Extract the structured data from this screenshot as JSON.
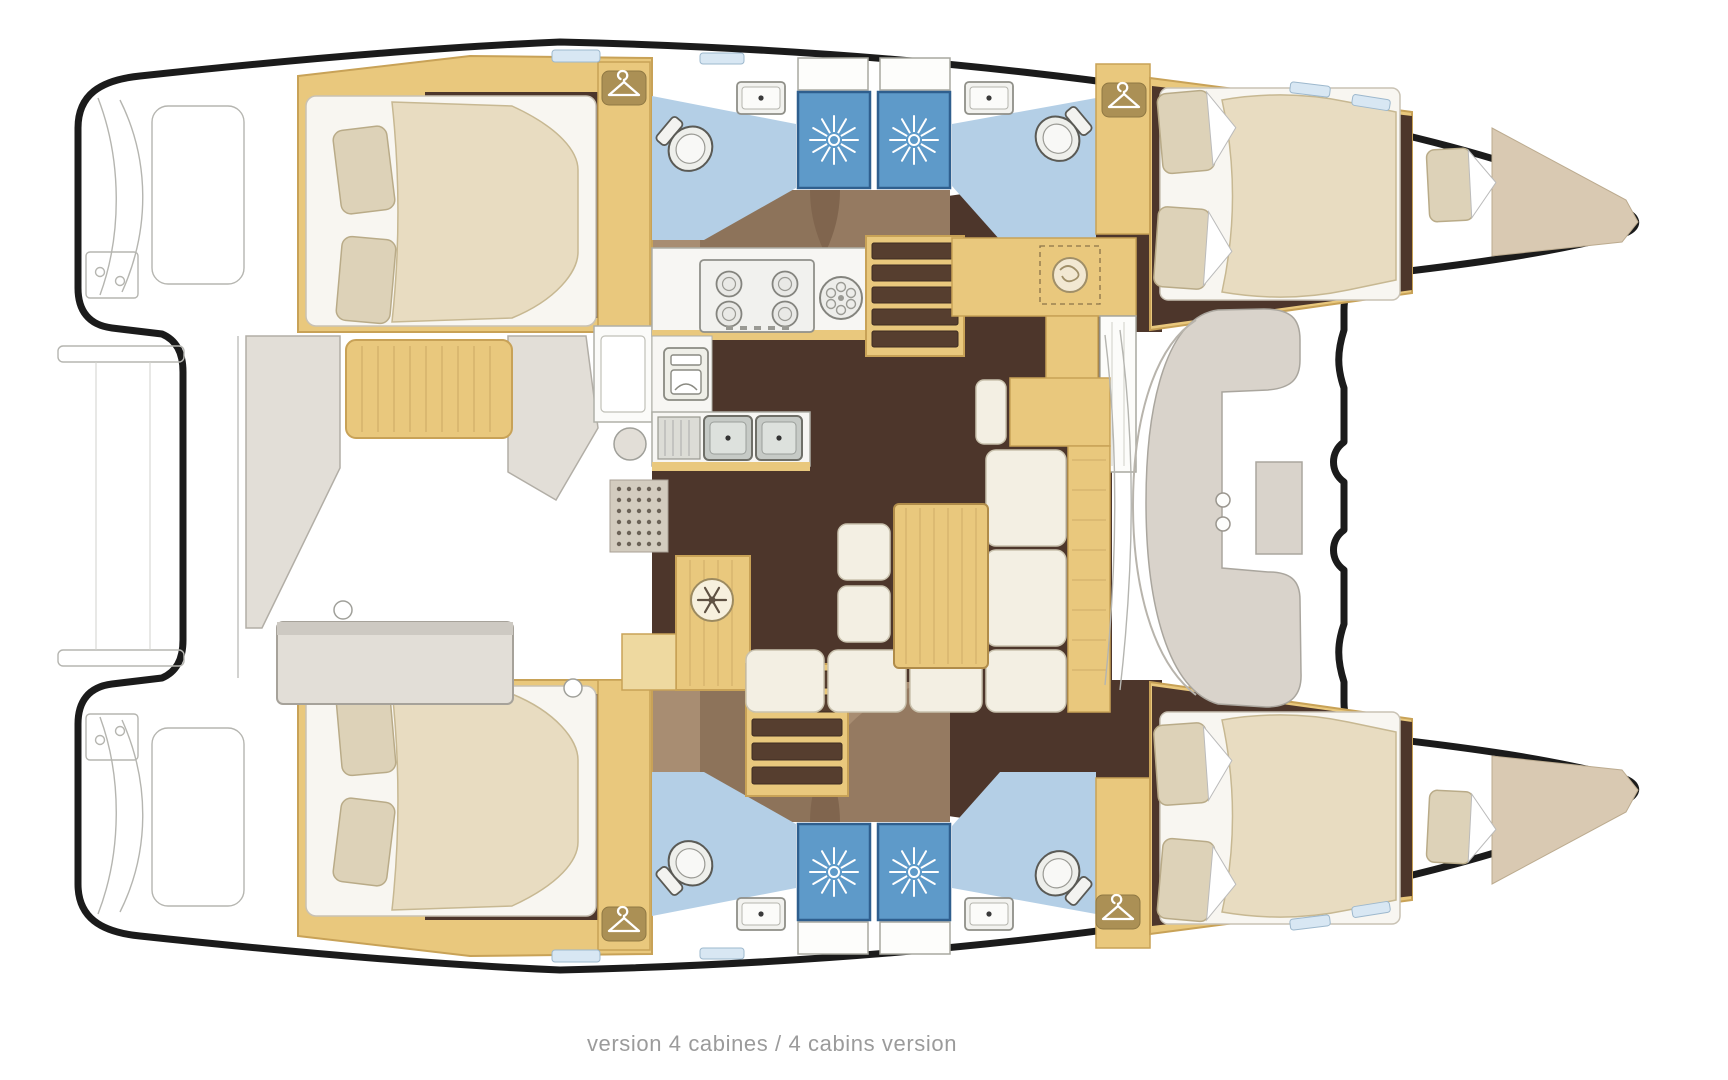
{
  "caption": {
    "text": "version 4 cabines / 4 cabins version"
  },
  "colors": {
    "outline": "#1b1b1b",
    "wood": "#e9c87d",
    "wood_dark": "#c8a257",
    "floor_dark": "#4d362b",
    "floor_walk": "#a88d72",
    "bath_blue": "#b4cfe6",
    "shower_blue": "#5e9ac9",
    "mattress": "#e8dcc1",
    "pillow": "#ddd2b8",
    "sofa": "#f3efe3",
    "cockpit_gray": "#e2ded7",
    "forepeak": "#d9c9b2",
    "caption": "#9b9b9b"
  },
  "icons": [
    {
      "name": "hanger-icon",
      "shape": "white clothes hanger on tan plate"
    },
    {
      "name": "shower-icon",
      "shape": "white starburst on blue square"
    },
    {
      "name": "toilet-icon",
      "shape": "oval bowl with tank"
    },
    {
      "name": "sink-icon",
      "shape": "rectangle basin with drain dot"
    },
    {
      "name": "stove-icon",
      "shape": "four burner rings"
    },
    {
      "name": "burner-icon",
      "shape": "round burner ring"
    },
    {
      "name": "oven-icon",
      "shape": "oven door with handle"
    },
    {
      "name": "snowflake-icon",
      "shape": "snowflake in circle (fridge)"
    },
    {
      "name": "icebox-icon",
      "shape": "swirl in circle"
    },
    {
      "name": "stairs-icon",
      "shape": "dark treads in wood frame"
    }
  ]
}
